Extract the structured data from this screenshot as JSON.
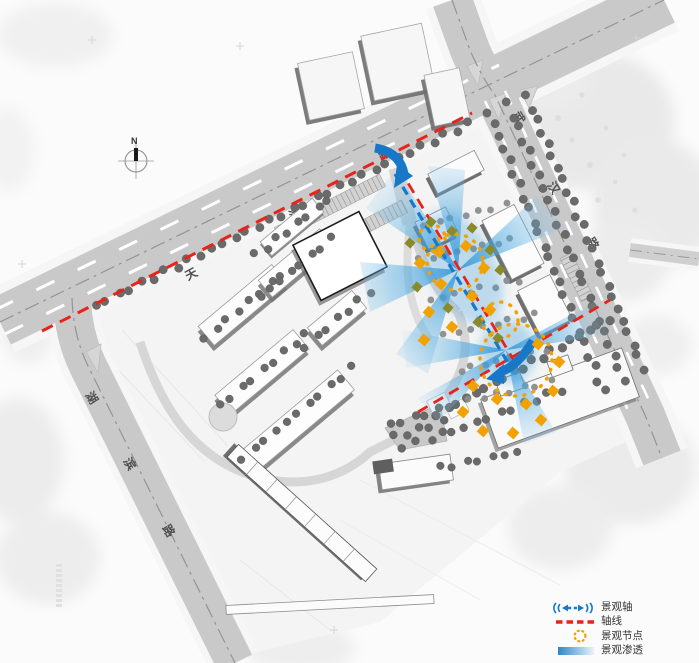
{
  "roads": {
    "tianjin": {
      "name": "天津路",
      "chars": [
        "天",
        "津",
        "路"
      ]
    },
    "wuhan": {
      "name": "武汉路",
      "chars": [
        "武",
        "汉",
        "路"
      ]
    },
    "hubin": {
      "name": "湖滨路",
      "chars": [
        "湖",
        "滨",
        "路"
      ]
    }
  },
  "compass": {
    "north_label": "N"
  },
  "legend": {
    "items": [
      {
        "id": "landscape-axis",
        "label": "景观轴",
        "symbol": "blue-double-dashed-arrow",
        "color": "#1878c8"
      },
      {
        "id": "axis-line",
        "label": "轴线",
        "symbol": "red-dashed-line",
        "color": "#e8231a"
      },
      {
        "id": "landscape-node",
        "label": "景观节点",
        "symbol": "orange-dotted-circle",
        "color": "#f2a200"
      },
      {
        "id": "landscape-penetration",
        "label": "景观渗透",
        "symbol": "blue-gradient-bar",
        "color": "#2e86c8"
      }
    ]
  },
  "colors": {
    "landscape_axis_blue": "#1878c8",
    "axis_red": "#e8231a",
    "node_orange": "#f2a200",
    "penetration_blue": "#2e90d0",
    "road_gray": "#c9c9c9",
    "tree_gray": "#6a6a6a"
  }
}
